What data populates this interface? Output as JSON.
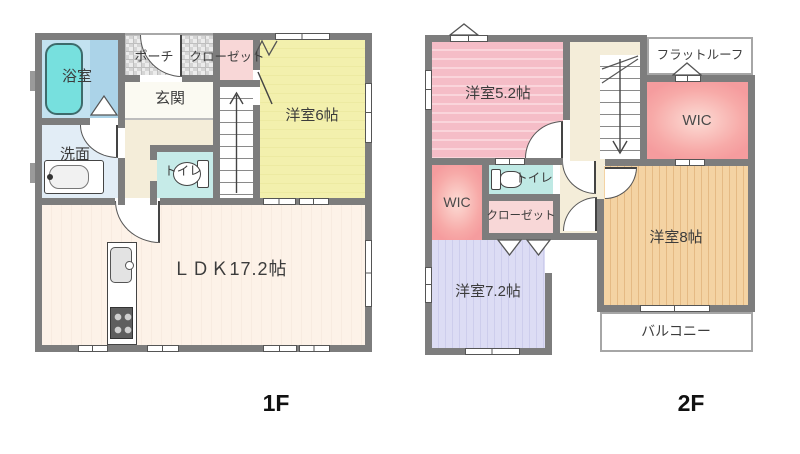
{
  "floors": [
    {
      "id": "1F",
      "label": "1F",
      "rooms": {
        "bathroom": {
          "label": "浴室"
        },
        "porch": {
          "label": "ポーチ"
        },
        "closet": {
          "label": "クローゼット"
        },
        "entrance": {
          "label": "玄関"
        },
        "washroom": {
          "label": "洗面"
        },
        "toilet": {
          "label": "トイレ"
        },
        "bedroom6": {
          "label": "洋室6帖"
        },
        "ldk": {
          "label": "ＬＤＫ17.2帖"
        }
      }
    },
    {
      "id": "2F",
      "label": "2F",
      "rooms": {
        "bedroom52": {
          "label": "洋室5.2帖"
        },
        "flatRoof": {
          "label": "フラットルーフ"
        },
        "wicTop": {
          "label": "WIC"
        },
        "toilet": {
          "label": "トイレ"
        },
        "wicLeft": {
          "label": "WIC"
        },
        "closet": {
          "label": "クローゼット"
        },
        "bedroom8": {
          "label": "洋室8帖"
        },
        "bedroom72": {
          "label": "洋室7.2帖"
        },
        "balcony": {
          "label": "バルコニー"
        }
      }
    }
  ],
  "palette": {
    "wall": "#7d7d7d",
    "bathroomFloor": "#c3e2f0",
    "bathtub": "#77e0de",
    "washroom": "#e2edf6",
    "toilet1f": "#c6ebe8",
    "toilet2f": "#bfe9e4",
    "hall": "#f4edd9",
    "closet": "#f8d7d7",
    "bedroom6": "#f3f0ad",
    "ldk": "#fdf2e8",
    "bedroom52": "#f5bdc7",
    "bedroom72": "#dcdcf4",
    "bedroom8": "#f4d3a3",
    "wic": "#f59c9e",
    "exterior": "#ffffff"
  }
}
